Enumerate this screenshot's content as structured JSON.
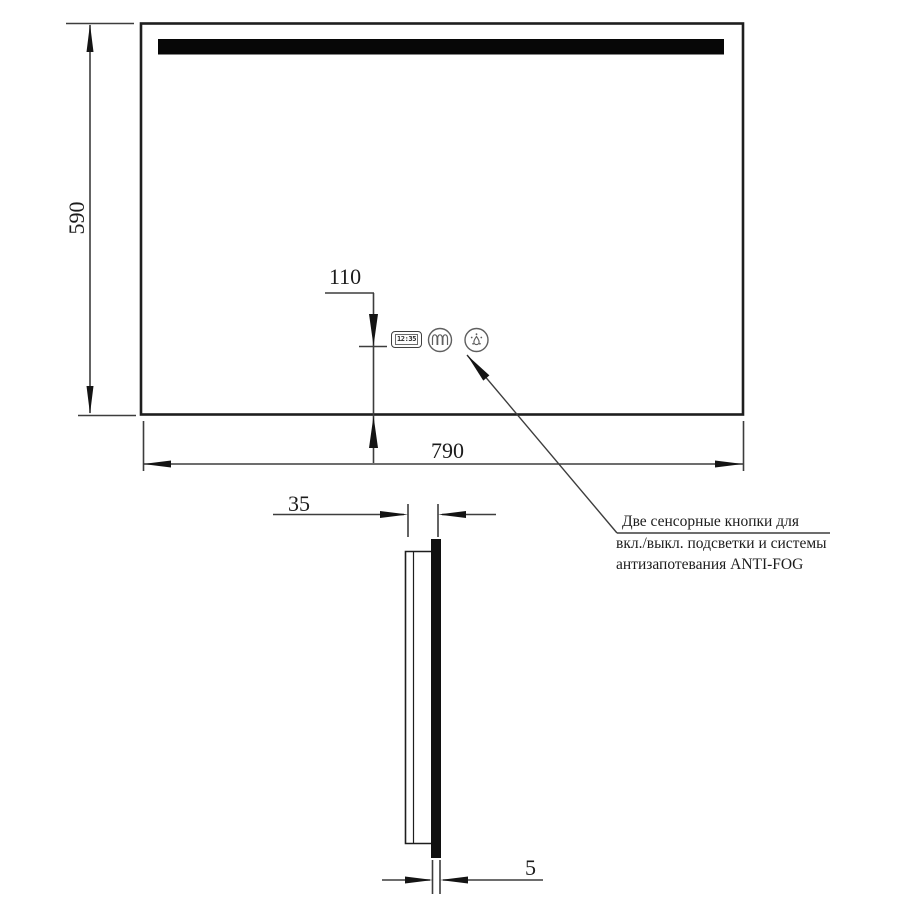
{
  "front_view": {
    "height_label": "590",
    "width_label": "790",
    "buttons_offset_label": "110",
    "clock_time": "12:35"
  },
  "side_view": {
    "depth_label": "35",
    "glass_thickness_label": "5"
  },
  "callout": {
    "line1": "Две сенсорные кнопки для",
    "line2": "вкл./выкл. подсветки и системы",
    "line3": "антизапотевания ANTI-FOG"
  },
  "icons": {
    "clock": "digital-clock-display",
    "backlight_button": "heater-coil-icon",
    "antifog_button": "anti-fog-spray-icon"
  },
  "colors": {
    "background": "#ffffff",
    "object_line": "#1e1e1e",
    "dimension_line": "#3d3d3d",
    "led_strip": "#070707",
    "text": "#1c1c1c"
  }
}
